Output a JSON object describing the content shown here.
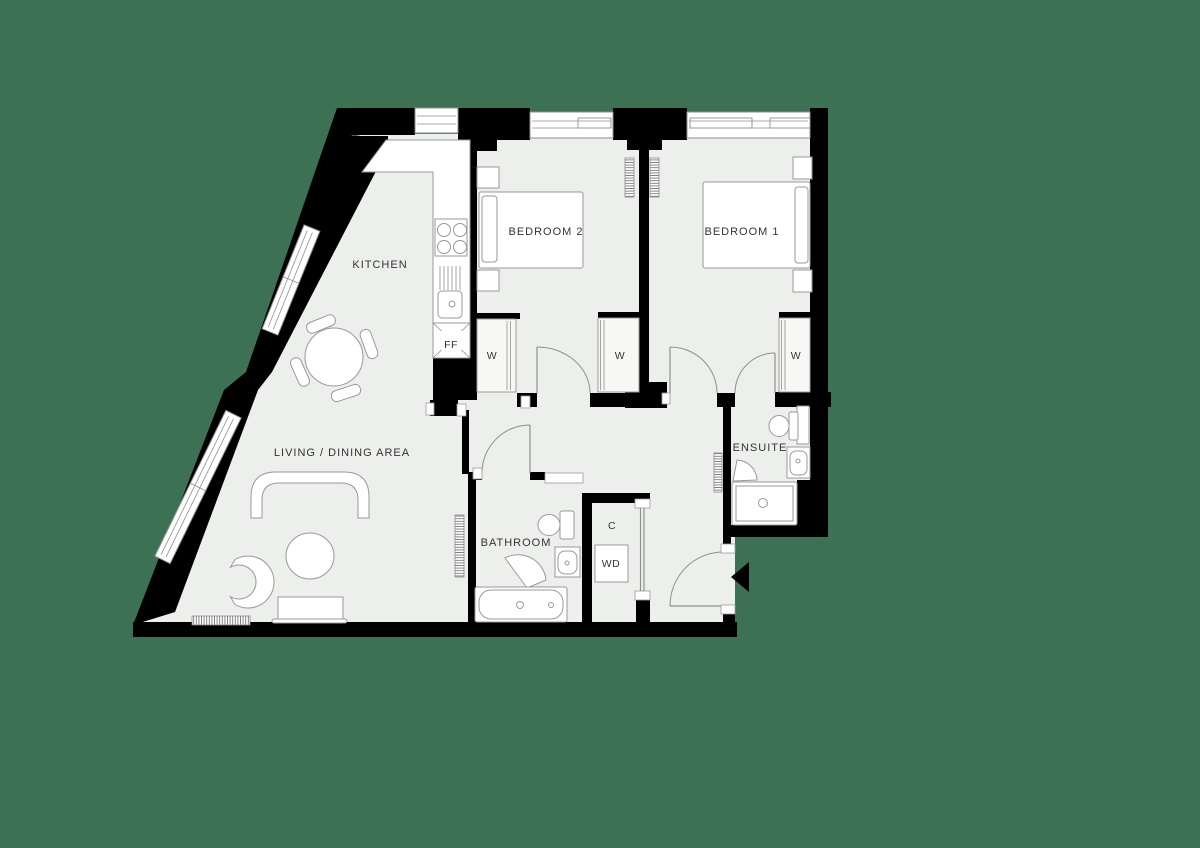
{
  "meta": {
    "type": "apartment-floor-plan",
    "bedrooms_shown": 2
  },
  "colors": {
    "background": "#3d7153",
    "floor": "#edefec",
    "wall": "#000000",
    "outline": "#8f8f8f",
    "text": "#333333"
  },
  "rooms": {
    "kitchen": {
      "label": "KITCHEN"
    },
    "living_dining": {
      "label": "LIVING / DINING AREA"
    },
    "bedroom2": {
      "label": "BEDROOM 2"
    },
    "bedroom1": {
      "label": "BEDROOM 1"
    },
    "bathroom": {
      "label": "BATHROOM"
    },
    "ensuite": {
      "label": "ENSUITE"
    }
  },
  "annotations": {
    "wardrobe": "W",
    "fridge_freezer": "FF",
    "cupboard": "C",
    "washer_dryer": "WD"
  }
}
